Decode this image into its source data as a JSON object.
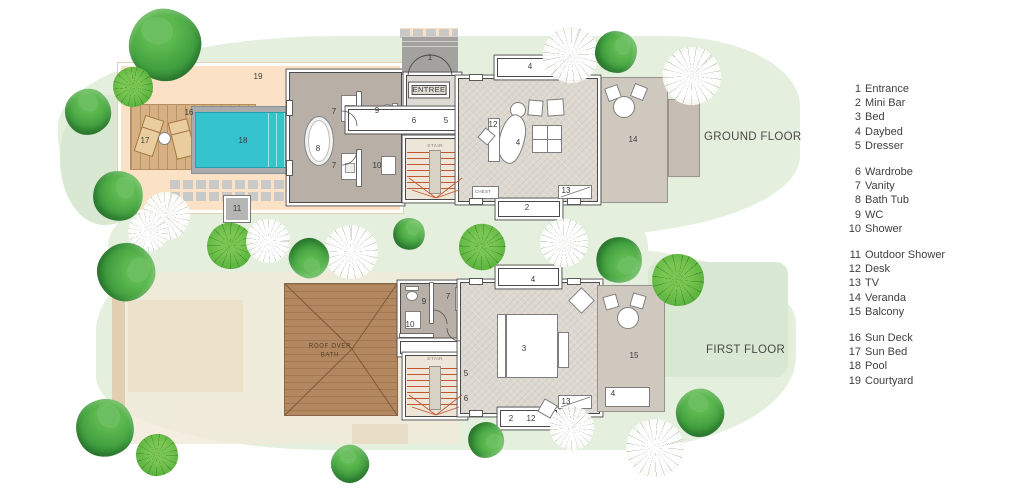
{
  "floors": {
    "ground": {
      "title": "GROUND FLOOR"
    },
    "first": {
      "title": "FIRST FLOOR"
    }
  },
  "legend": {
    "groups": [
      {
        "items": [
          {
            "num": "1",
            "label": "Entrance"
          },
          {
            "num": "2",
            "label": "Mini Bar"
          },
          {
            "num": "3",
            "label": "Bed"
          },
          {
            "num": "4",
            "label": "Daybed"
          },
          {
            "num": "5",
            "label": "Dresser"
          }
        ]
      },
      {
        "items": [
          {
            "num": "6",
            "label": "Wardrobe"
          },
          {
            "num": "7",
            "label": "Vanity"
          },
          {
            "num": "8",
            "label": "Bath Tub"
          },
          {
            "num": "9",
            "label": "WC"
          },
          {
            "num": "10",
            "label": "Shower"
          }
        ]
      },
      {
        "items": [
          {
            "num": "11",
            "label": "Outdoor Shower"
          },
          {
            "num": "12",
            "label": "Desk"
          },
          {
            "num": "13",
            "label": "TV"
          },
          {
            "num": "14",
            "label": "Veranda"
          },
          {
            "num": "15",
            "label": "Balcony"
          }
        ]
      },
      {
        "items": [
          {
            "num": "16",
            "label": "Sun Deck"
          },
          {
            "num": "17",
            "label": "Sun Bed"
          },
          {
            "num": "18",
            "label": "Pool"
          },
          {
            "num": "19",
            "label": "Courtyard"
          }
        ]
      }
    ]
  },
  "plan_labels": {
    "ground": [
      {
        "t": "19",
        "x": 258,
        "y": 77
      },
      {
        "t": "16",
        "x": 189,
        "y": 113
      },
      {
        "t": "17",
        "x": 145,
        "y": 141
      },
      {
        "t": "18",
        "x": 243,
        "y": 141
      },
      {
        "t": "11",
        "x": 237,
        "y": 209
      },
      {
        "t": "8",
        "x": 318,
        "y": 149
      },
      {
        "t": "7",
        "x": 334,
        "y": 112
      },
      {
        "t": "7",
        "x": 334,
        "y": 166
      },
      {
        "t": "9",
        "x": 377,
        "y": 111
      },
      {
        "t": "10",
        "x": 377,
        "y": 166
      },
      {
        "t": "1",
        "x": 430,
        "y": 58
      },
      {
        "t": "ENTREE",
        "x": 429,
        "y": 90,
        "cls": "room"
      },
      {
        "t": "6",
        "x": 414,
        "y": 121
      },
      {
        "t": "5",
        "x": 446,
        "y": 121
      },
      {
        "t": "STAIR",
        "x": 435,
        "y": 146,
        "cls": "xs"
      },
      {
        "t": "12",
        "x": 493,
        "y": 125
      },
      {
        "t": "4",
        "x": 518,
        "y": 143
      },
      {
        "t": "4",
        "x": 530,
        "y": 67
      },
      {
        "t": "CHEST",
        "x": 483,
        "y": 192,
        "cls": "xxs"
      },
      {
        "t": "13",
        "x": 566,
        "y": 191
      },
      {
        "t": "2",
        "x": 527,
        "y": 208
      },
      {
        "t": "14",
        "x": 633,
        "y": 140
      }
    ],
    "first": [
      {
        "t": "ROOF OVER",
        "x": 330,
        "y": 346,
        "cls": "roof"
      },
      {
        "t": "BATH",
        "x": 330,
        "y": 355,
        "cls": "roof"
      },
      {
        "t": "9",
        "x": 424,
        "y": 302
      },
      {
        "t": "7",
        "x": 448,
        "y": 297
      },
      {
        "t": "10",
        "x": 410,
        "y": 325
      },
      {
        "t": "STAIR",
        "x": 435,
        "y": 359,
        "cls": "xs"
      },
      {
        "t": "5",
        "x": 466,
        "y": 374
      },
      {
        "t": "6",
        "x": 466,
        "y": 399
      },
      {
        "t": "3",
        "x": 524,
        "y": 349
      },
      {
        "t": "4",
        "x": 533,
        "y": 280
      },
      {
        "t": "13",
        "x": 566,
        "y": 402
      },
      {
        "t": "2",
        "x": 511,
        "y": 419
      },
      {
        "t": "12",
        "x": 531,
        "y": 419
      },
      {
        "t": "15",
        "x": 634,
        "y": 356
      },
      {
        "t": "4",
        "x": 613,
        "y": 394
      }
    ]
  },
  "scene": {
    "trees": [
      {
        "type": "solid",
        "x": 165,
        "y": 45,
        "d": 72,
        "rot": 10
      },
      {
        "type": "fan",
        "x": 133,
        "y": 87,
        "d": 40,
        "rot": 0
      },
      {
        "type": "solid",
        "x": 88,
        "y": 112,
        "d": 46,
        "rot": 40
      },
      {
        "type": "solid",
        "x": 118,
        "y": 196,
        "d": 50,
        "rot": 80
      },
      {
        "type": "sketch",
        "x": 166,
        "y": 216,
        "d": 48,
        "rot": 15
      },
      {
        "type": "sketch",
        "x": 148,
        "y": 232,
        "d": 40,
        "rot": 60
      },
      {
        "type": "solid",
        "x": 126,
        "y": 272,
        "d": 58,
        "rot": 120
      },
      {
        "type": "fan",
        "x": 230,
        "y": 246,
        "d": 46,
        "rot": 30
      },
      {
        "type": "sketch",
        "x": 268,
        "y": 241,
        "d": 44,
        "rot": 90
      },
      {
        "type": "sketch",
        "x": 351,
        "y": 252,
        "d": 54,
        "rot": 0
      },
      {
        "type": "solid",
        "x": 309,
        "y": 258,
        "d": 40,
        "rot": 200
      },
      {
        "type": "solid",
        "x": 409,
        "y": 234,
        "d": 32,
        "rot": 70
      },
      {
        "type": "fan",
        "x": 482,
        "y": 247,
        "d": 46,
        "rot": 55
      },
      {
        "type": "sketch",
        "x": 564,
        "y": 243,
        "d": 48,
        "rot": 120
      },
      {
        "type": "solid",
        "x": 619,
        "y": 260,
        "d": 46,
        "rot": 160
      },
      {
        "type": "sketch",
        "x": 571,
        "y": 55,
        "d": 56,
        "rot": 20
      },
      {
        "type": "solid",
        "x": 616,
        "y": 52,
        "d": 42,
        "rot": 90
      },
      {
        "type": "sketch",
        "x": 692,
        "y": 76,
        "d": 58,
        "rot": 45
      },
      {
        "type": "fan",
        "x": 678,
        "y": 280,
        "d": 52,
        "rot": 15
      },
      {
        "type": "solid",
        "x": 700,
        "y": 413,
        "d": 48,
        "rot": 30
      },
      {
        "type": "sketch",
        "x": 655,
        "y": 448,
        "d": 58,
        "rot": 75
      },
      {
        "type": "sketch",
        "x": 572,
        "y": 428,
        "d": 44,
        "rot": 10
      },
      {
        "type": "solid",
        "x": 486,
        "y": 440,
        "d": 36,
        "rot": 140
      },
      {
        "type": "solid",
        "x": 105,
        "y": 428,
        "d": 58,
        "rot": 55
      },
      {
        "type": "fan",
        "x": 157,
        "y": 455,
        "d": 42,
        "rot": 80
      },
      {
        "type": "solid",
        "x": 350,
        "y": 464,
        "d": 38,
        "rot": 25
      }
    ]
  },
  "colors": {
    "lawn": "#e4efde",
    "lawn2": "#d9e8d2",
    "courtyard": "#fbe2c6",
    "deck": "#d7b183",
    "pool": "#35c3cf",
    "coping": "#a9acad",
    "paver": "#c9c9c7",
    "bath": "#b8afa6",
    "floor": "#dcd8cf",
    "veranda": "#cfc8be",
    "entree": "#dedbd4",
    "porch": "#a3a29e",
    "wall": "#4a4a4a",
    "stair": "#c2562f",
    "stairfloor": "#ece5d8",
    "roof": "#b3875f",
    "ghost": "#f1ead9",
    "ink": "#3d3d3d",
    "tree_light": "#5cb84f",
    "tree_mid": "#3f9e3e",
    "tree_dark": "#2d7f33",
    "tree_fan": "#5cb43e"
  }
}
